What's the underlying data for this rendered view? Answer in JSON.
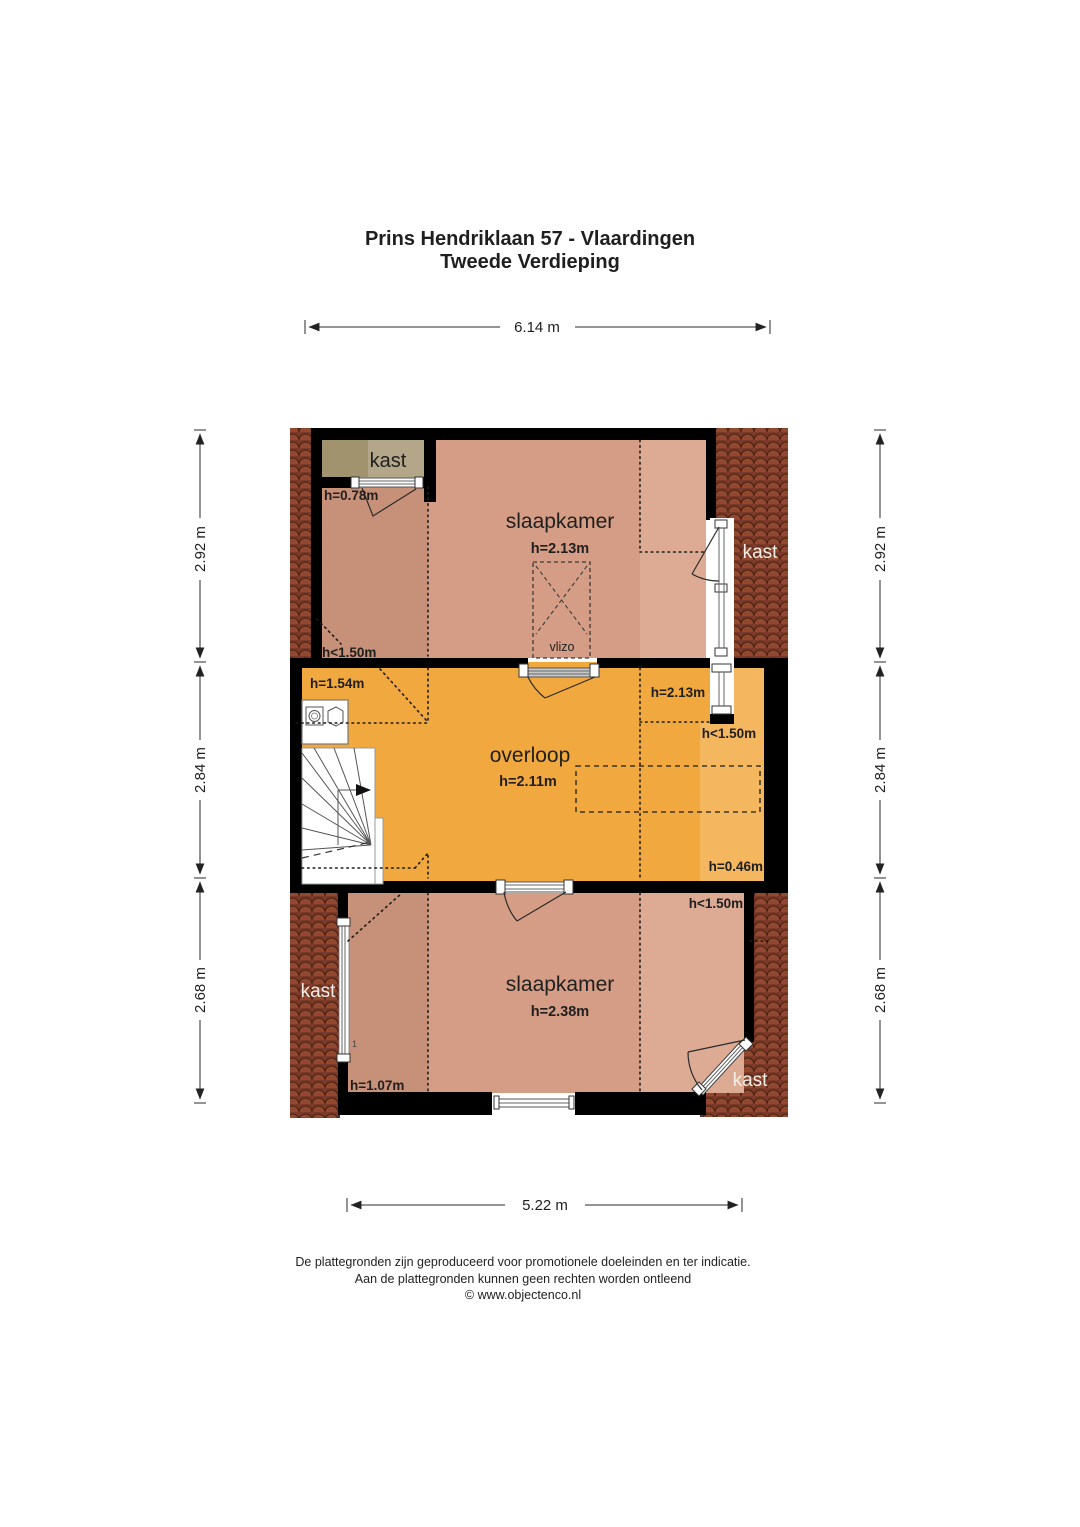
{
  "title": {
    "line1": "Prins Hendriklaan 57 - Vlaardingen",
    "line2": "Tweede Verdieping"
  },
  "dims": {
    "top": "6.14 m",
    "bottom": "5.22 m",
    "left": [
      "2.92 m",
      "2.84 m",
      "2.68 m"
    ],
    "right": [
      "2.92 m",
      "2.84 m",
      "2.68 m"
    ]
  },
  "rooms": {
    "bedroom_top": {
      "name": "slaapkamer",
      "height": "h=2.13m"
    },
    "landing": {
      "name": "overloop",
      "height": "h=2.11m"
    },
    "bedroom_bottom": {
      "name": "slaapkamer",
      "height": "h=2.38m"
    }
  },
  "closets": {
    "top_left": "kast",
    "top_right": "kast",
    "bottom_left": "kast",
    "bottom_right": "kast"
  },
  "labels": {
    "closet_tl_height": "h=0.78m",
    "bed_top_low": "h<1.50m",
    "landing_left": "h=1.54m",
    "landing_right": "h=2.13m",
    "landing_right_low": "h<1.50m",
    "landing_bottom_right": "h=0.46m",
    "bed_bottom_low": "h<1.50m",
    "bed_bottom_left": "h=1.07m",
    "stair_mark": "1",
    "attic_hatch": "vlizo"
  },
  "footer": {
    "line1": "De plattegronden zijn geproduceerd voor promotionele doeleinden en ter indicatie.",
    "line2": "Aan de plattegronden kunnen geen rechten worden ontleend",
    "line3": "© www.objectenco.nl"
  },
  "colors": {
    "room_salmon": "#d59d85",
    "room_salmon_dark": "#c79078",
    "room_salmon_light": "#ddab94",
    "landing_orange": "#f1a83e",
    "landing_orange_light": "#f4b75f",
    "closet_khaki": "#b3a689",
    "closet_khaki_dark": "#a2936f",
    "roof_base": "#7b3a28",
    "roof_tile": "#91482f",
    "wall": "#000000"
  }
}
